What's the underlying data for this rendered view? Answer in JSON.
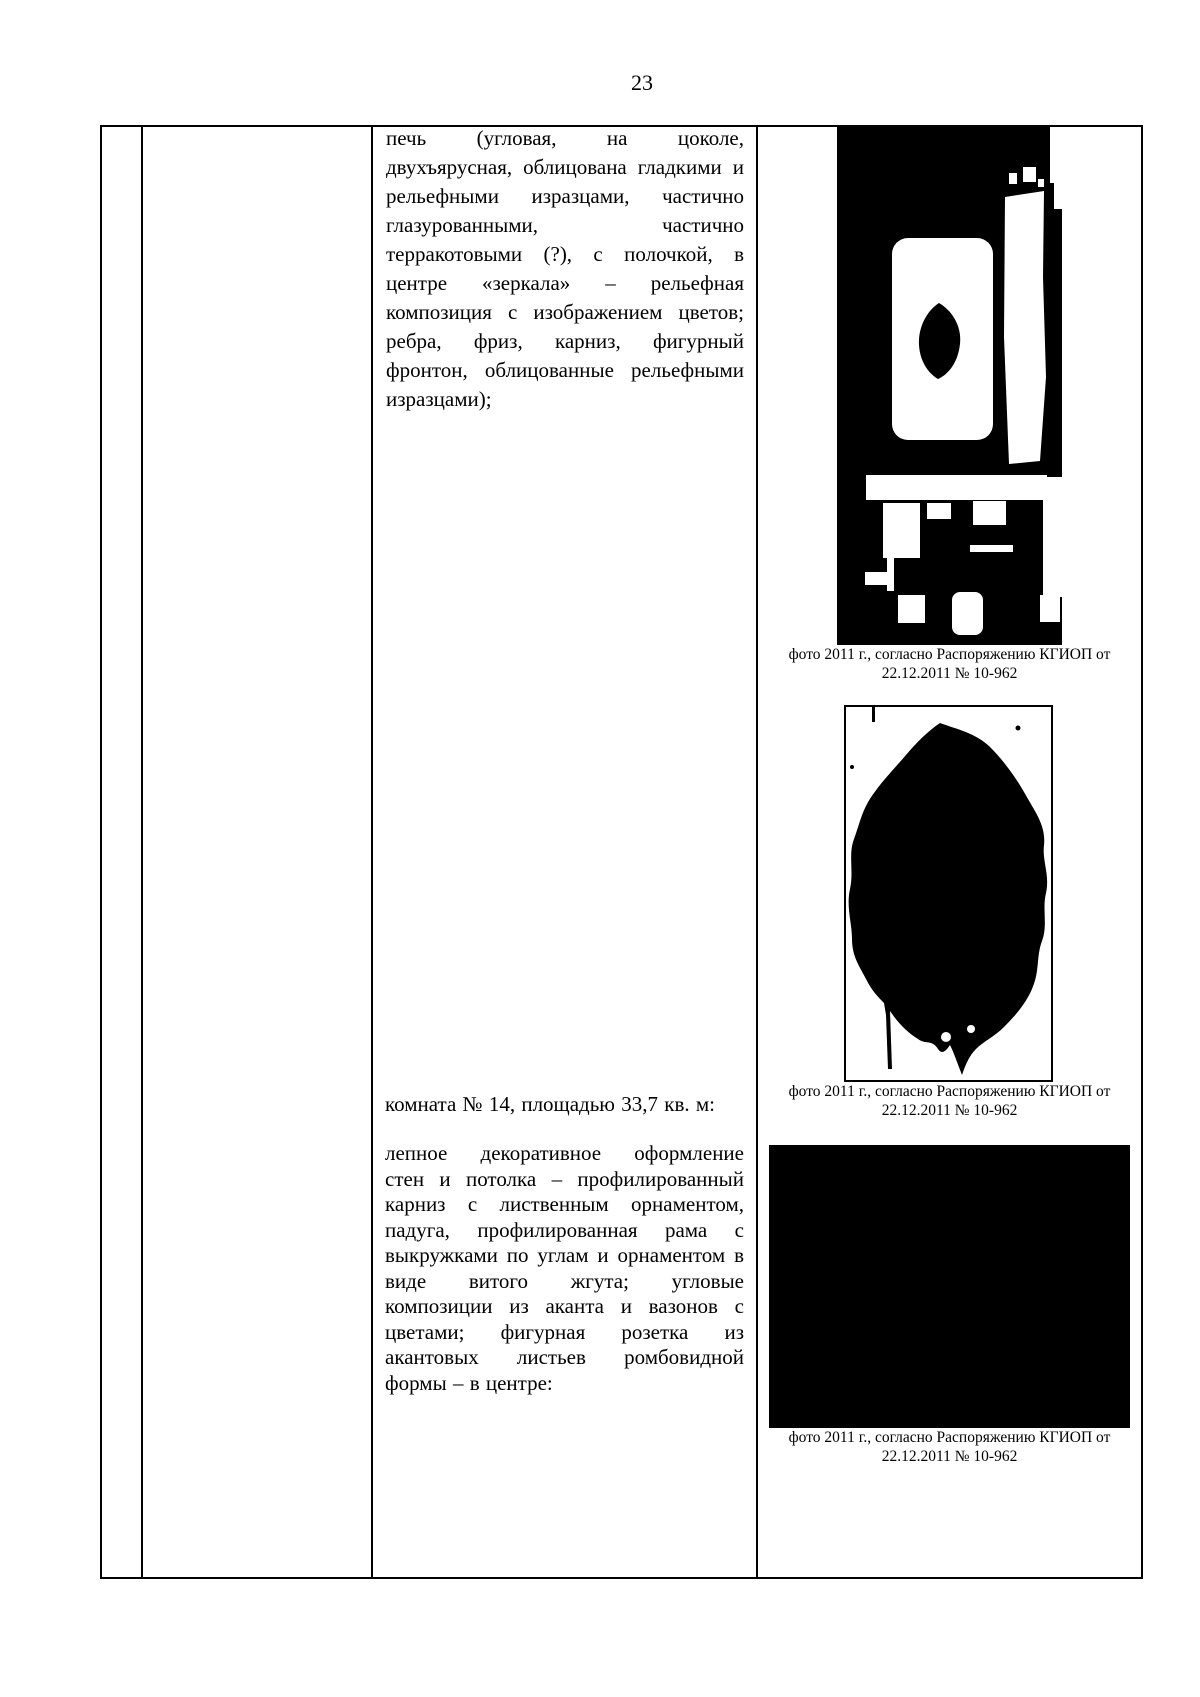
{
  "page_number": "23",
  "colors": {
    "ink": "#000000",
    "paper": "#ffffff"
  },
  "table": {
    "text_column": {
      "stove_paragraph_lines": [
        "печь (угловая, на цоколе,",
        "двухъярусная, облицована гладкими и",
        "рельефными изразцами, частично",
        "глазурованными, частично",
        "терракотовыми (?), с полочкой, в",
        "центре «зеркала» – рельефная",
        "композиция с изображением цветов;",
        "ребра, фриз, карниз, фигурный",
        "фронтон, облицованные рельефными",
        "изразцами);"
      ],
      "room_heading": "комната № 14, площадью 33,7 кв. м:",
      "decor_paragraph_lines": [
        "лепное декоративное оформление",
        "стен и потолка – профилированный",
        "карниз с лиственным орнаментом,",
        "падуга, профилированная рама с",
        "выкружками по углам и орнаментом в",
        "виде витого жгута; угловые",
        "композиции из аканта и вазонов с",
        "цветами; фигурная розетка из",
        "акантовых листьев ромбовидной",
        "формы – в центре:"
      ]
    },
    "photo_column": {
      "photos": [
        {
          "caption_lines": [
            "фото 2011 г., согласно Распоряжению КГИОП от",
            "22.12.2011 № 10-962"
          ]
        },
        {
          "caption_lines": [
            "фото 2011 г., согласно Распоряжению КГИОП от",
            "22.12.2011 № 10-962"
          ]
        },
        {
          "caption_lines": [
            "фото 2011 г., согласно Распоряжению КГИОП от",
            "22.12.2011 № 10-962"
          ]
        }
      ]
    }
  }
}
